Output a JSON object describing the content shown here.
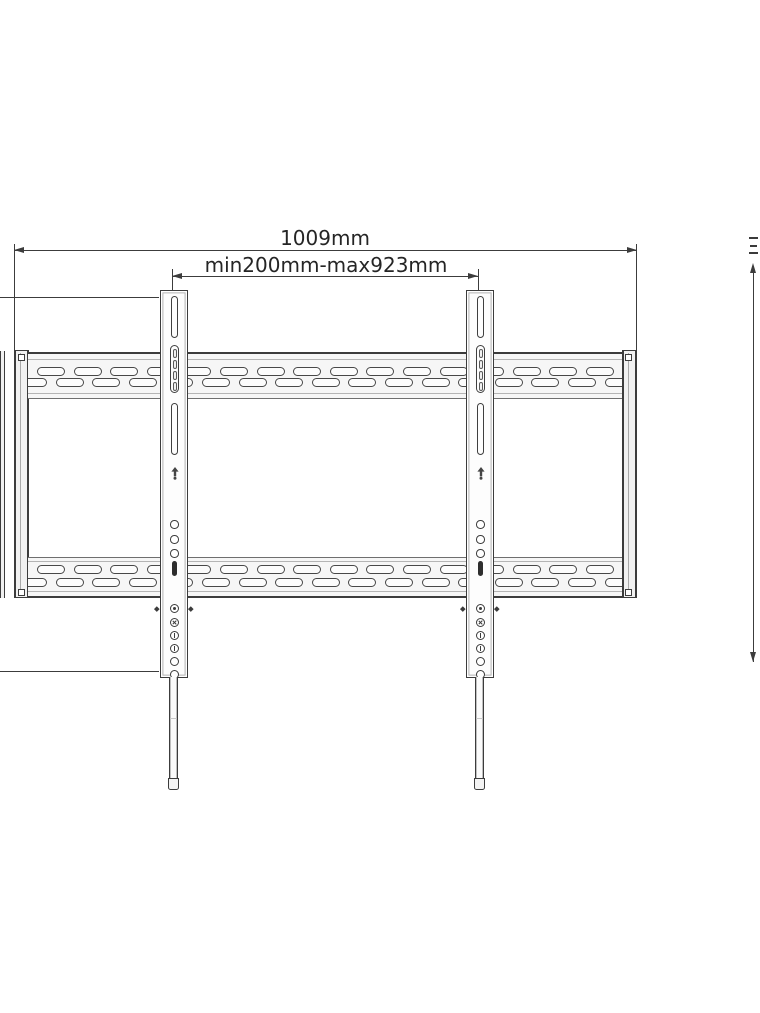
{
  "annotations": {
    "overall_width_label": "1009mm",
    "hole_spacing_label": "min200mm-max923mm"
  },
  "colors": {
    "line": "#3c3c3c",
    "line_light": "#b2b2b2",
    "band_fill": "#f6f6f6",
    "dark_fill": "#2e2e2e",
    "text": "#252525",
    "background": "#ffffff"
  },
  "geometry": {
    "plate": {
      "slot": {
        "w": 28,
        "h": 9,
        "pitch": 36.6
      },
      "bands": [
        {
          "rows": [
            {
              "y": 13,
              "x0": 9,
              "count": 16
            },
            {
              "y": 24,
              "x0": -9,
              "count": 17
            }
          ]
        },
        {
          "rows": [
            {
              "y": 6.5,
              "x0": 9,
              "count": 16
            },
            {
              "y": 19.5,
              "x0": -9,
              "count": 17
            }
          ]
        }
      ]
    },
    "rails": {
      "x": [
        160,
        466
      ],
      "top": 290,
      "w": 27.5,
      "h": 387.5,
      "mid_hole_tops": [
        229,
        244,
        258
      ],
      "low_holes": [
        {
          "y": 312.5,
          "mark": "dot"
        },
        {
          "y": 326.5,
          "mark": "cross"
        },
        {
          "y": 339.5,
          "mark": "bar"
        },
        {
          "y": 352.5,
          "mark": "bar"
        },
        {
          "y": 365.5,
          "mark": "none"
        },
        {
          "y": 378.5,
          "mark": "none"
        }
      ],
      "rod": {
        "top": 677,
        "h": 101,
        "w": 9,
        "joint_y": 41,
        "cap_h": 12
      }
    }
  }
}
